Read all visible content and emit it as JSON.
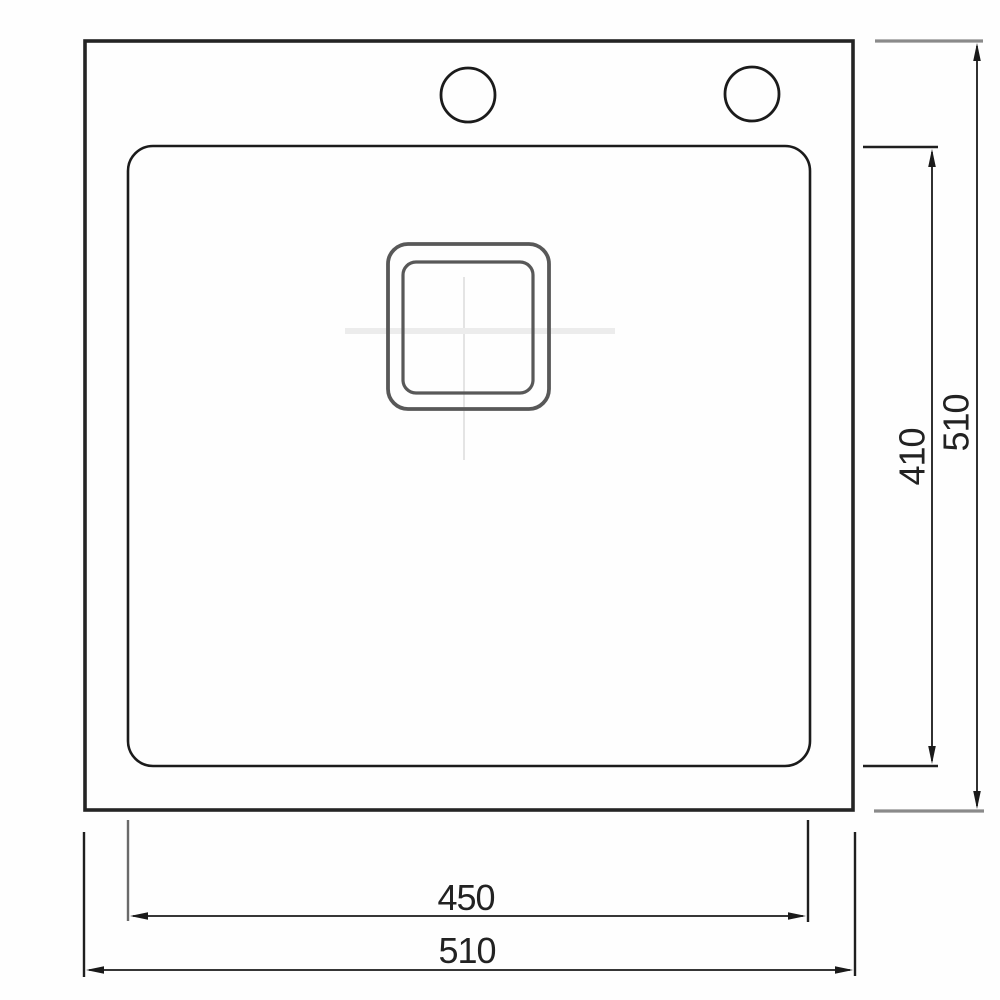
{
  "dimensions": {
    "outer_height": "510",
    "inner_height": "410",
    "inner_width": "450",
    "outer_width": "510"
  },
  "colors": {
    "outline": "#1f1f1f",
    "drain_outline": "#585858",
    "extension_gray": "#8a8a8a",
    "centerline": "#dcdcdc",
    "background": "#ffffff"
  }
}
